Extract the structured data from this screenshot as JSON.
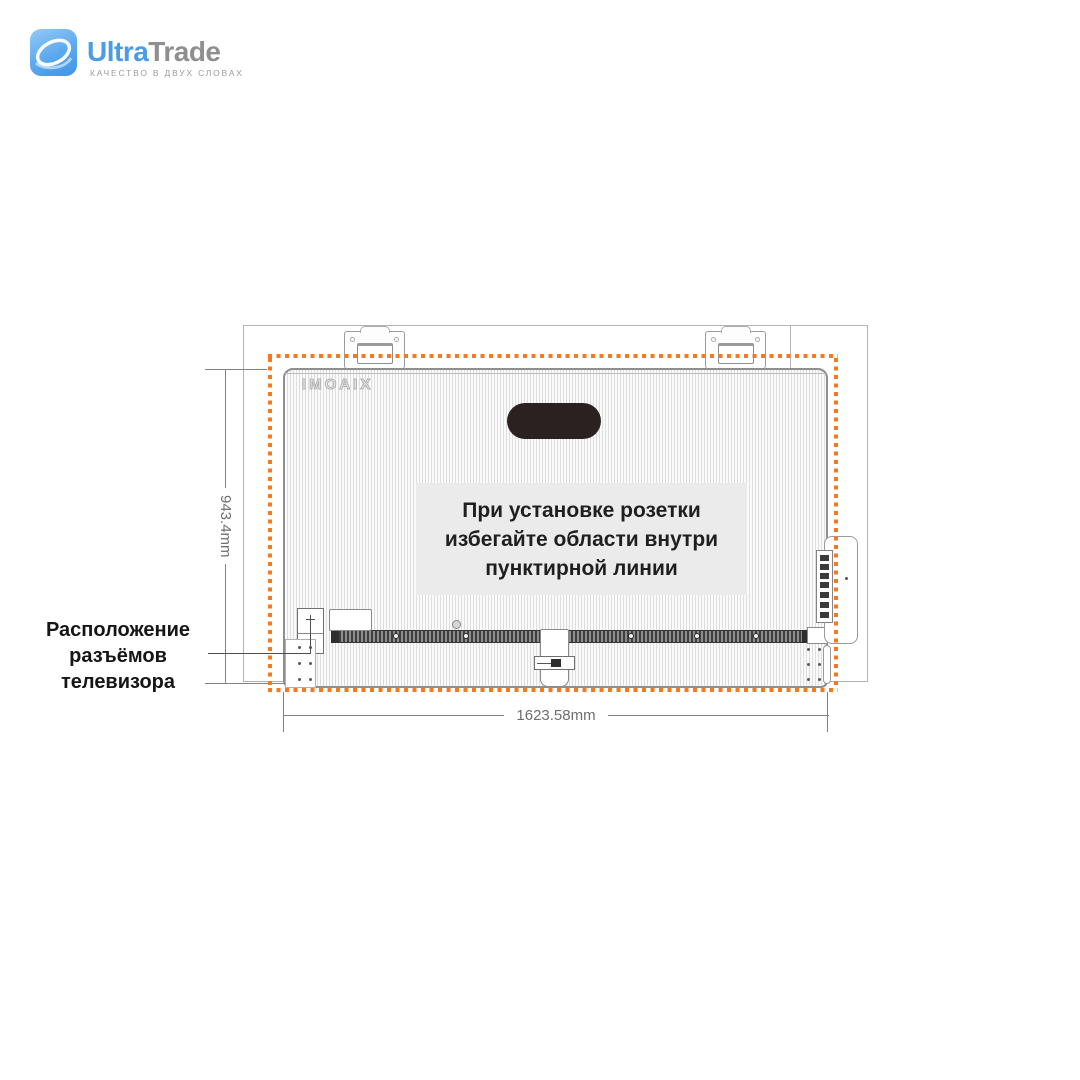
{
  "header": {
    "brand_first": "Ultra",
    "brand_second": "Trade",
    "tagline": "КАЧЕСТВО В ДВУХ СЛОВАХ"
  },
  "diagram": {
    "tv_brand_logo": "XIAOMI",
    "notice_lines": [
      "При установке розетки",
      "избегайте области внутри",
      "пунктирной линии"
    ],
    "connector_label_lines": [
      "Расположение",
      "разъёмов",
      "телевизора"
    ],
    "height_dimension": "943.4mm",
    "width_dimension": "1623.58mm"
  },
  "colors": {
    "brand_blue": "#4a9ce7",
    "brand_gray": "#8f8f8f",
    "keep_out_orange": "#f5791d",
    "handle_dark": "#2a2220"
  }
}
